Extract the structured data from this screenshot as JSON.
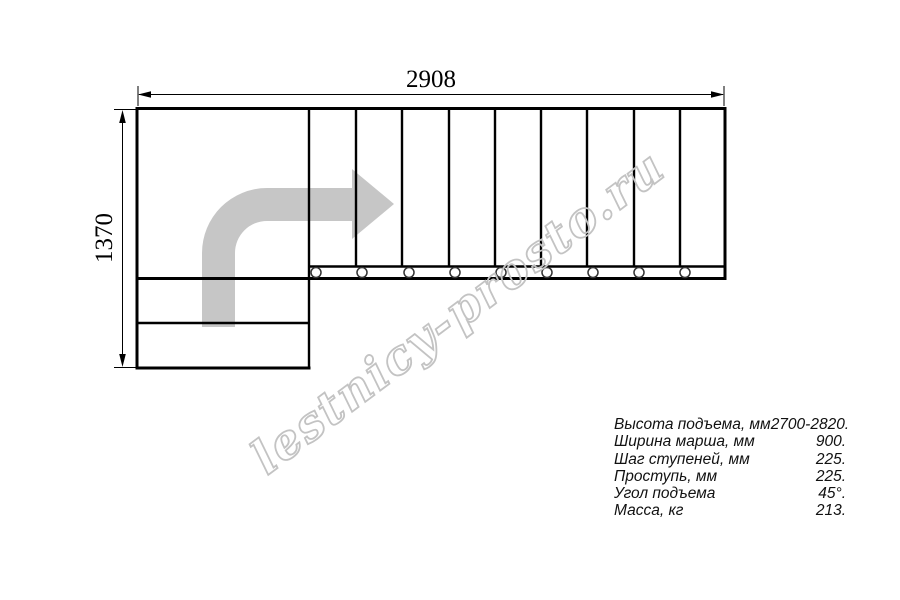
{
  "dimensions": {
    "width_label": "2908",
    "height_label": "1370"
  },
  "watermark": {
    "text": "lestnicy-prosto.ru",
    "color": "#c3c3c3"
  },
  "plan": {
    "tread_count": 9,
    "lower_step_count": 2,
    "bolt_count": 9,
    "arrow_color": "#c6c6c6",
    "line_color": "#000000"
  },
  "specs": {
    "rows": [
      {
        "label": "Высота подъема, мм",
        "value": "2700-2820."
      },
      {
        "label": "Ширина марша, мм",
        "value": "900."
      },
      {
        "label": "Шаг ступеней, мм",
        "value": "225."
      },
      {
        "label": "Проступь, мм",
        "value": "225."
      },
      {
        "label": "Угол подъема",
        "value": "45°."
      },
      {
        "label": "Масса, кг",
        "value": "213."
      }
    ]
  }
}
